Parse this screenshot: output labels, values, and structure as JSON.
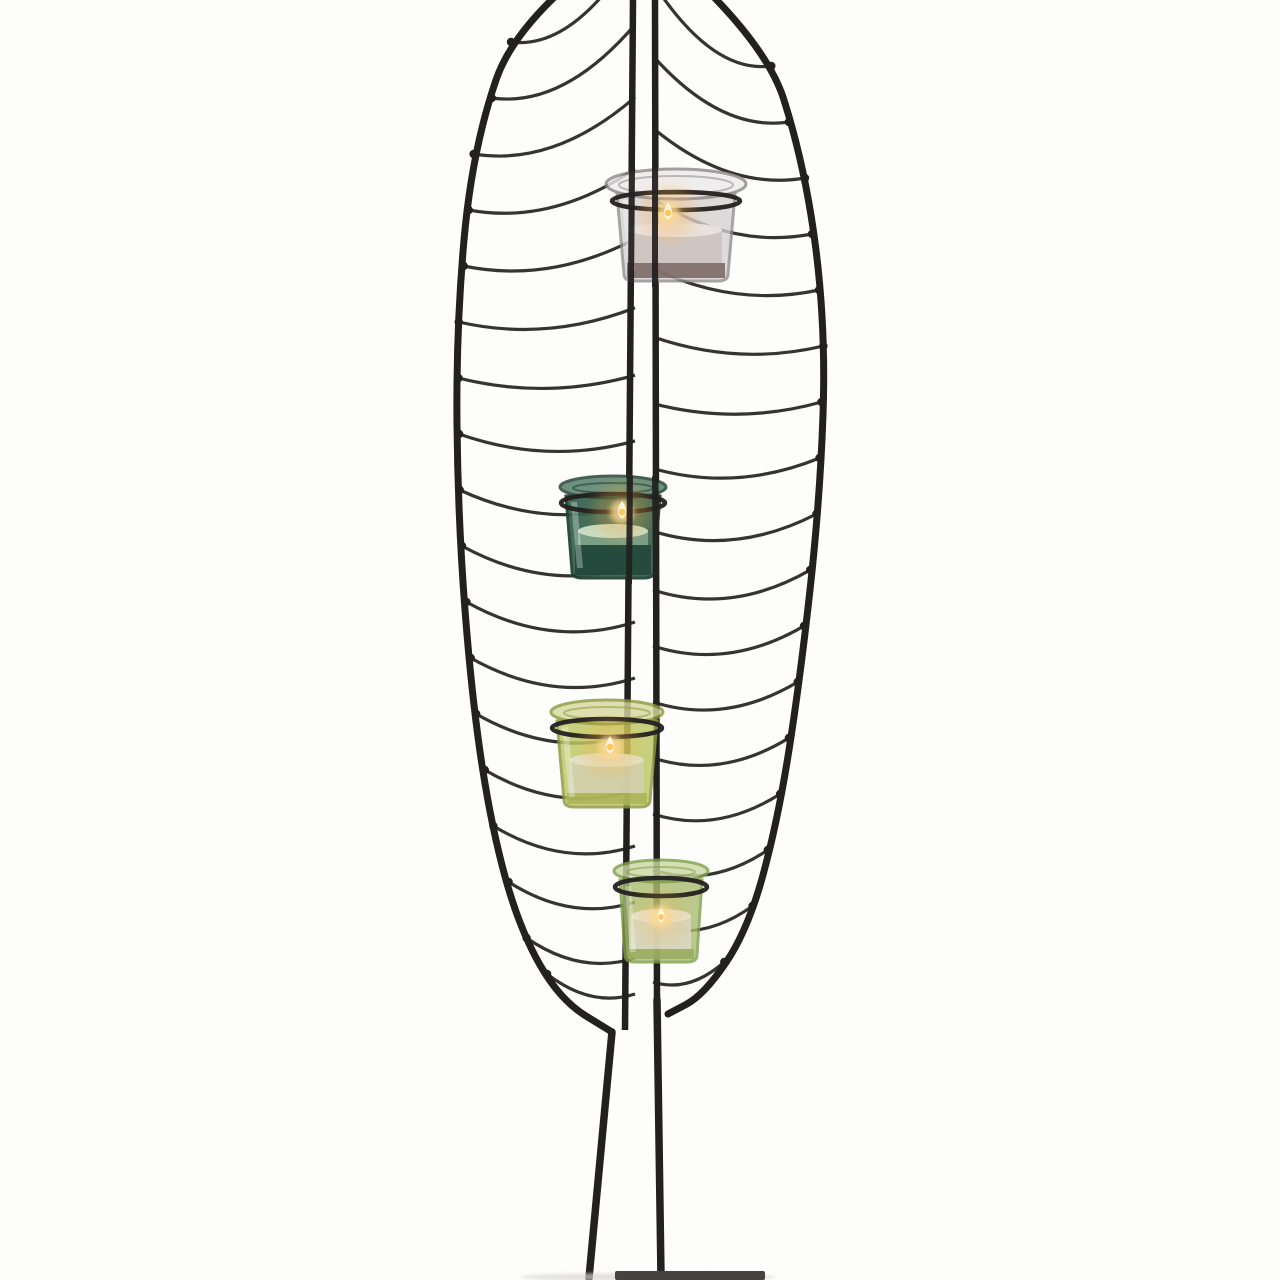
{
  "scene": {
    "type": "product-photo",
    "subject": "Leaf-shaped black wire tealight holder stand with four glass votive cups",
    "background_color": "#fdfdfc",
    "wire_color": "#232020",
    "rib_color": "#2b2828",
    "base_color": "#454240",
    "shadow_color": "#d8d6d3",
    "votive_count": 4,
    "lit_candle_count": 4
  },
  "geometry": {
    "stem_left": {
      "x_top": 633,
      "y_top": 0,
      "x_bot": 625,
      "y_bot": 1030
    },
    "stem_right": {
      "x_top": 655,
      "y_top": 0,
      "x_bot": 657,
      "y_bot": 1000
    },
    "rib_spacing": 56,
    "outline_left": [
      [
        640,
        -70
      ],
      [
        520,
        10
      ],
      [
        472,
        150
      ],
      [
        456,
        330
      ],
      [
        458,
        520
      ],
      [
        472,
        700
      ],
      [
        492,
        830
      ],
      [
        520,
        930
      ],
      [
        560,
        1000
      ],
      [
        612,
        1032
      ]
    ],
    "outline_right": [
      [
        640,
        -70
      ],
      [
        762,
        30
      ],
      [
        806,
        170
      ],
      [
        826,
        330
      ],
      [
        820,
        500
      ],
      [
        800,
        680
      ],
      [
        778,
        820
      ],
      [
        748,
        930
      ],
      [
        704,
        995
      ],
      [
        668,
        1014
      ]
    ],
    "left_leg": [
      612,
      1032,
      589,
      1278
    ],
    "right_leg": [
      657,
      1000,
      661,
      1277
    ],
    "base_plate": {
      "x": 615,
      "y": 1271,
      "width": 150,
      "height": 9
    },
    "knots_left": {
      "start": 42,
      "end": 940,
      "extra": 974
    },
    "knots_right": {
      "start": 66,
      "end": 963
    },
    "front_wire_segments": [
      [
        632,
        166,
        631,
        287
      ],
      [
        655,
        166,
        655,
        287
      ],
      [
        630,
        476,
        629,
        584
      ],
      [
        655,
        476,
        656,
        584
      ]
    ]
  },
  "votives": [
    {
      "name": "clear-glass-votive",
      "lit": true,
      "cx": 676,
      "rim_y": 184,
      "rim_rx": 70,
      "rim_ry": 15,
      "top_y": 194,
      "top_hw": 59,
      "bot_y": 281,
      "bot_hw": 52,
      "wax_y": 230,
      "dark_y": 263,
      "glass_color": "#d6d1d3",
      "rim_color": "#eceaeb",
      "edge_color": "#8f898b",
      "wax_color": "#cdc3bf",
      "wax_top_color": "#eae3de",
      "inner_dark": "#6f5b56",
      "glass_opacity": 0.78,
      "flame": {
        "x": 668,
        "y": 213,
        "glow": 0.55
      }
    },
    {
      "name": "dark-green-glass-votive",
      "lit": true,
      "cx": 613,
      "rim_y": 487,
      "rim_rx": 53,
      "rim_ry": 11,
      "top_y": 496,
      "top_hw": 47,
      "bot_y": 578,
      "bot_hw": 41,
      "wax_y": 531,
      "dark_y": 545,
      "glass_color": "#35604d",
      "rim_color": "#4e7a63",
      "edge_color": "#1e3d33",
      "wax_color": "#7fa489",
      "wax_top_color": "#cfe0c6",
      "inner_dark": "#1d4336",
      "glass_opacity": 0.92,
      "flame": {
        "x": 622,
        "y": 512,
        "glow": 0.6
      }
    },
    {
      "name": "olive-green-glass-votive",
      "lit": true,
      "cx": 607,
      "rim_y": 712,
      "rim_rx": 56,
      "rim_ry": 12,
      "top_y": 721,
      "top_hw": 50,
      "bot_y": 807,
      "bot_hw": 43,
      "wax_y": 760,
      "dark_y": 793,
      "glass_color": "#bcc763",
      "rim_color": "#d6d9a0",
      "edge_color": "#8e9a3f",
      "wax_color": "#d2cfae",
      "wax_top_color": "#e4e2c8",
      "inner_dark": "#a8b052",
      "glass_opacity": 0.82,
      "flame": {
        "x": 610,
        "y": 747,
        "glow": 0.55
      }
    },
    {
      "name": "light-green-glass-votive",
      "lit": true,
      "cx": 661,
      "rim_y": 871,
      "rim_rx": 47,
      "rim_ry": 11,
      "top_y": 880,
      "top_hw": 41,
      "bot_y": 962,
      "bot_hw": 36,
      "wax_y": 916,
      "dark_y": 949,
      "glass_color": "#a9bd72",
      "rim_color": "#cdd9a4",
      "edge_color": "#7fa04b",
      "wax_color": "#d9d8c4",
      "wax_top_color": "#e6e4d4",
      "inner_dark": "#97aa5c",
      "glass_opacity": 0.8,
      "flame": {
        "x": 661,
        "y": 917,
        "glow": 0.35
      }
    }
  ]
}
